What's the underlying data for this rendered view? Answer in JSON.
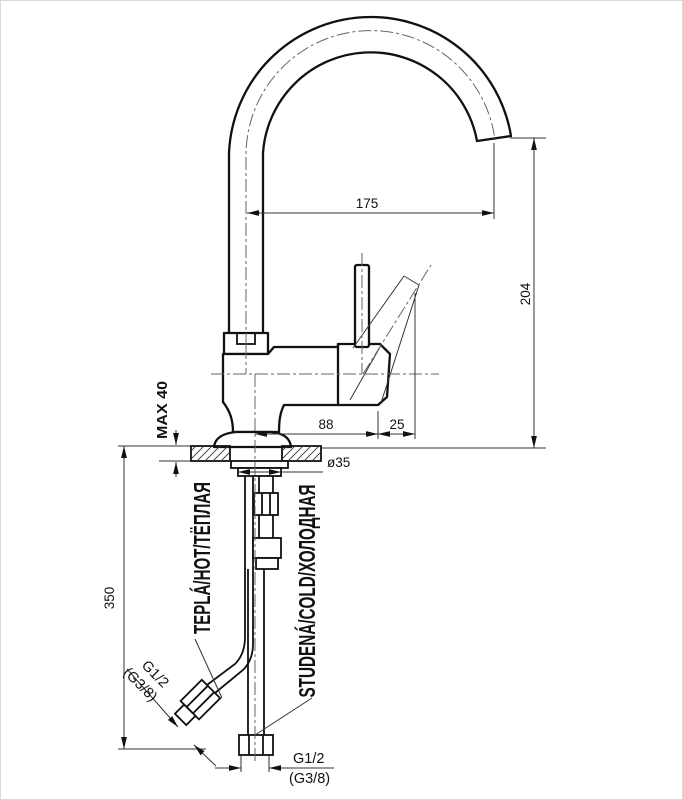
{
  "drawing": {
    "title": "single-lever-sink-mixer-technical-drawing",
    "dimensions": {
      "spout_reach": "175",
      "spout_height": "204",
      "body_length": "88",
      "lever_overhang": "25",
      "max_deck_thickness": "MAX 40",
      "hole_diameter": "ø35",
      "hose_length": "350"
    },
    "labels": {
      "hot": "TEPLÁ/HOT/ТЁПЛАЯ",
      "cold": "STUDENÁ/COLD/ХОЛОДНАЯ"
    },
    "connections": {
      "angled": {
        "size": "G1/2",
        "alt_size": "(G3/8)"
      },
      "straight": {
        "size": "G1/2",
        "alt_size": "(G3/8)"
      }
    },
    "colors": {
      "line": "#111111",
      "centerline": "#666666",
      "background": "#ffffff"
    }
  }
}
